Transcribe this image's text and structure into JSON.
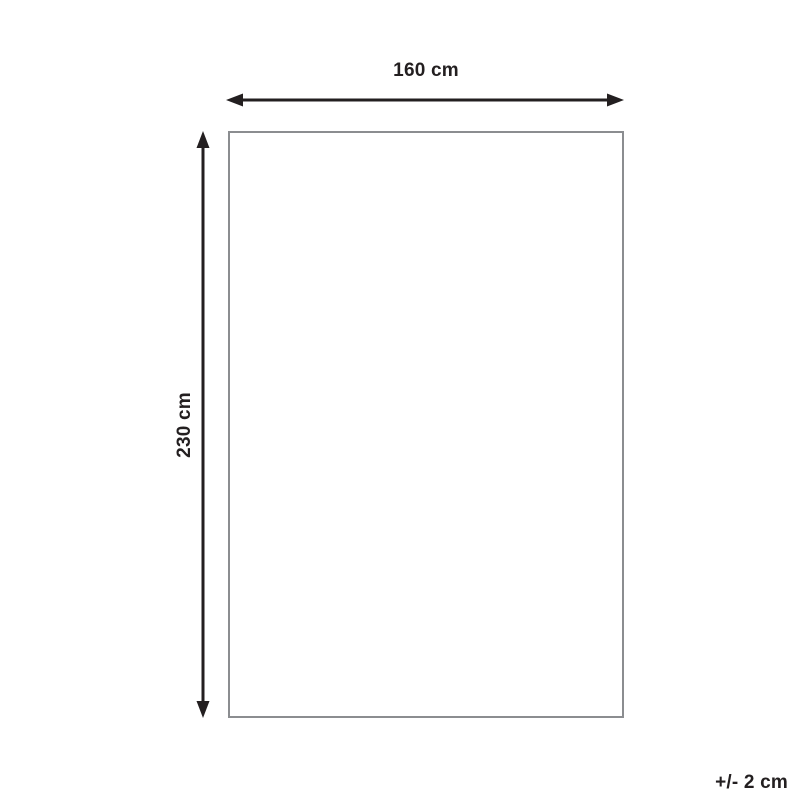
{
  "diagram": {
    "type": "product-dimension-diagram",
    "width_label": "160 cm",
    "height_label": "230 cm",
    "tolerance_label": "+/- 2 cm"
  },
  "colors": {
    "background": "#ffffff",
    "arrow": "#231f20",
    "text": "#231f20",
    "rectangle_border": "#8b8d90"
  }
}
